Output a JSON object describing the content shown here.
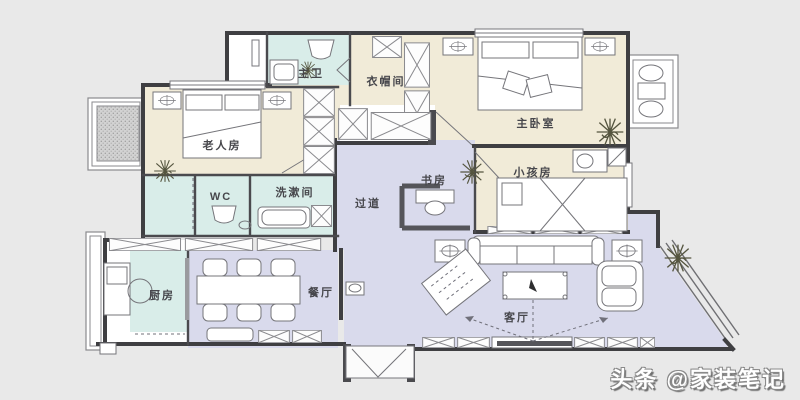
{
  "plan_title": "three-bedroom apartment floor plan",
  "rooms": {
    "master_bath": {
      "label": "主卫"
    },
    "cloakroom": {
      "label": "衣帽间"
    },
    "master_bedroom": {
      "label": "主卧室"
    },
    "elder_room": {
      "label": "老人房"
    },
    "wc": {
      "label": "WC"
    },
    "washroom": {
      "label": "洗漱间"
    },
    "hallway": {
      "label": "过道"
    },
    "study": {
      "label": "书房"
    },
    "kids_room": {
      "label": "小孩房"
    },
    "kitchen": {
      "label": "厨房"
    },
    "dining_room": {
      "label": "餐厅"
    },
    "living_room": {
      "label": "客厅"
    }
  },
  "watermark": {
    "text": "头条 @家装笔记"
  },
  "colors": {
    "background": "#e9e9e9",
    "wall": "#3f3f42",
    "bedroom_fill": "#f1ebd8",
    "bathroom_fill": "#d9ede9",
    "public_fill": "#d9daec",
    "bay_hatch": "#cfcfcf",
    "label": "#47474c",
    "watermark_text": "#ffffff",
    "watermark_shadow": "#8a8a8a"
  }
}
